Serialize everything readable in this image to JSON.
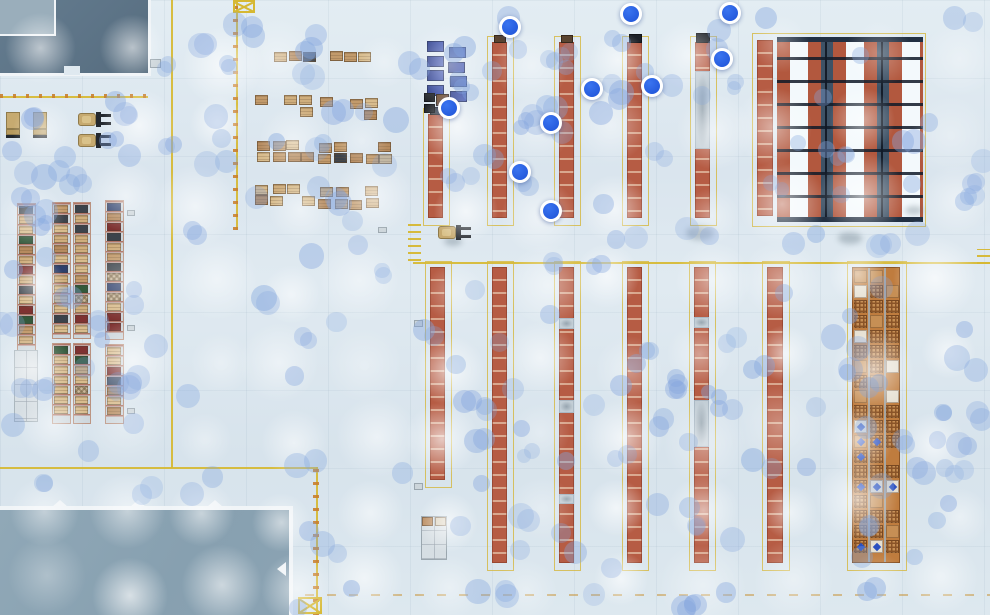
{
  "scene": {
    "label": "warehouse-floor-plan-top-view",
    "width": 990,
    "height": 615,
    "marker_count": 10
  },
  "palette": {
    "floor": "#dbe6ee",
    "zoneDark": "#5d7487",
    "zoneDarkPatch": "#9aaebb",
    "zoneDock": "#8ba3b3",
    "zoneBorder": "#f0f4f7",
    "yellow": "#d6b832",
    "orangeDash": "#c87f2e",
    "rackOrange": "#b65c44",
    "rackSep": "#d9a88f",
    "rackBorder": "rgba(135,58,38,0.6)",
    "rackGap": "#c3ced6",
    "capBrown": "#5a4430",
    "capDark": "#1d2127",
    "rbOrange": "#b2583e",
    "rbAisle": "#f3f9fc",
    "rbDark": "#3e5266",
    "rbBeam": "rgba(16,26,40,0.85)",
    "rbCap": "#223042",
    "denseBase": "#bf7c3e",
    "denseLattice": "#8a5428",
    "denseCell": "#c68f55",
    "denseWhite": "#e6e0d2",
    "denseBlue": "#2b50c0",
    "rowFrame": "#ccd5db",
    "rowBar": "rgba(168,84,62,0.75)",
    "tan1": "#cfae7d",
    "tan2": "#d8bc8d",
    "tan3": "#c29a6b",
    "tan4": "#b68b5f",
    "dark": "#3c434b",
    "green": "#33593b",
    "red": "#7e3231",
    "navy": "#2e3f6b",
    "checker": "#c9b79a",
    "bluePalletA": "#2c3d8c",
    "bluePalletB": "#4257b2",
    "vehicleBody": "#c6aa70",
    "vehicleTrim": "#8f7a4a",
    "vehicleDark": "#23282e",
    "dotRGB": "132,166,222",
    "marker": "#2257d8",
    "markerRing": "#ffffff",
    "smudge": "rgba(75,95,110,0.30)",
    "emptyRack": "#d6dee3",
    "emptyRackLine": "rgba(150,160,170,0.55)"
  },
  "markers": [
    [
      510,
      27
    ],
    [
      631,
      14
    ],
    [
      730,
      13
    ],
    [
      722,
      59
    ],
    [
      652,
      86
    ],
    [
      592,
      89
    ],
    [
      449,
      108
    ],
    [
      551,
      123
    ],
    [
      520,
      172
    ],
    [
      551,
      211
    ]
  ],
  "zones": {
    "building": {
      "rect": [
        0,
        0,
        148,
        73
      ],
      "patch": [
        0,
        0,
        54,
        34
      ],
      "notch": [
        64,
        66,
        16,
        9
      ]
    },
    "dock": {
      "rect": [
        0,
        506,
        289,
        109
      ],
      "teeth_x": [
        52,
        130,
        207
      ],
      "side_notch_y": 562
    }
  },
  "yellow_lines": {
    "solids": [
      [
        0,
        96,
        148,
        2
      ],
      [
        171,
        0,
        2,
        468
      ],
      [
        236,
        0,
        2,
        230
      ],
      [
        413,
        262,
        577,
        2
      ],
      [
        0,
        467,
        318,
        2
      ],
      [
        316,
        467,
        2,
        148
      ]
    ],
    "dash_overlays": [
      [
        0,
        94,
        148,
        4,
        "h"
      ],
      [
        233,
        0,
        5,
        230,
        "v"
      ],
      [
        313,
        467,
        6,
        148,
        "v"
      ]
    ],
    "dashed": [
      [
        305,
        594,
        685,
        2
      ]
    ],
    "xboxes": [
      [
        233,
        0,
        22,
        13
      ],
      [
        298,
        597,
        24,
        17
      ]
    ],
    "hatches": [
      [
        408,
        221,
        13,
        40
      ],
      [
        977,
        249,
        13,
        15
      ]
    ]
  },
  "racks": {
    "top": [
      {
        "r": [
          428,
          114,
          15,
          104
        ]
      },
      {
        "r": [
          492,
          42,
          15,
          176
        ]
      },
      {
        "r": [
          559,
          42,
          15,
          176
        ]
      },
      {
        "r": [
          627,
          42,
          15,
          176
        ]
      },
      {
        "r": [
          695,
          42,
          15,
          176
        ],
        "gaps": [
          [
            70,
            78
          ]
        ]
      }
    ],
    "bottom": [
      {
        "r": [
          430,
          267,
          15,
          213
        ]
      },
      {
        "r": [
          492,
          267,
          15,
          296
        ]
      },
      {
        "r": [
          559,
          267,
          15,
          296
        ],
        "gaps": [
          [
            317,
            11
          ],
          [
            399,
            13
          ],
          [
            493,
            10
          ]
        ]
      },
      {
        "r": [
          627,
          267,
          15,
          296
        ]
      },
      {
        "r": [
          694,
          267,
          15,
          296
        ],
        "gaps": [
          [
            316,
            11
          ],
          [
            399,
            47
          ]
        ]
      },
      {
        "r": [
          767,
          267,
          16,
          296
        ]
      }
    ],
    "caps": [
      [
        494,
        35,
        12,
        8,
        "capBrown"
      ],
      [
        561,
        35,
        12,
        8,
        "capBrown"
      ],
      [
        629,
        34,
        13,
        9,
        "capDark"
      ],
      [
        696,
        33,
        14,
        10,
        "capDark"
      ],
      [
        430,
        107,
        12,
        8,
        "dark"
      ]
    ]
  },
  "right_block": {
    "rect": [
      777,
      37,
      146,
      185
    ],
    "side_col": [
      757,
      40,
      16,
      176
    ],
    "outline": [
      752,
      33,
      172,
      192
    ],
    "beam_step": 23,
    "cap_h": 5
  },
  "dense_rack": {
    "rect": [
      852,
      267,
      48,
      296
    ],
    "cols": [
      1,
      17,
      33
    ],
    "cell_w": 13,
    "row_step": 15,
    "cell_h": 13
  },
  "left_rows": {
    "segments": [
      [
        17,
        203,
        19,
        148
      ],
      [
        52,
        202,
        19,
        137
      ],
      [
        52,
        343,
        19,
        81
      ],
      [
        73,
        202,
        18,
        137
      ],
      [
        73,
        343,
        18,
        81
      ],
      [
        105,
        200,
        19,
        140
      ],
      [
        105,
        344,
        19,
        80
      ]
    ],
    "empty_rack": [
      14,
      350,
      24,
      72
    ]
  },
  "pallet_clusters": [
    [
      257,
      51,
      62,
      22
    ],
    [
      328,
      51,
      46,
      21
    ],
    [
      253,
      94,
      64,
      24
    ],
    [
      318,
      97,
      74,
      24
    ],
    [
      255,
      139,
      64,
      24
    ],
    [
      318,
      141,
      76,
      25
    ],
    [
      255,
      183,
      70,
      26
    ],
    [
      318,
      186,
      74,
      26
    ]
  ],
  "blue_pallets": {
    "cols": [
      426,
      448
    ],
    "row_y": [
      41,
      47
    ],
    "step": 14.5,
    "rows": 4,
    "w": 17,
    "h": 11
  },
  "crates": [
    [
      424,
      93,
      11,
      9,
      "#23262b"
    ],
    [
      424,
      104,
      11,
      9,
      "#23262b"
    ],
    [
      436,
      94,
      13,
      12,
      "#6e4c30"
    ]
  ],
  "vehicles": {
    "trucks_down": [
      [
        6,
        112
      ],
      [
        33,
        112
      ]
    ],
    "forklifts_right": [
      [
        78,
        111
      ],
      [
        78,
        132
      ],
      [
        438,
        224
      ]
    ]
  },
  "shelves": {
    "bottom_shelf": [
      421,
      516,
      26,
      44
    ],
    "shelf_pallets": [
      [
        422,
        517,
        11,
        9,
        "#b98a5c"
      ],
      [
        435,
        517,
        11,
        9,
        "#d8cdb6"
      ]
    ]
  },
  "small_items": [
    [
      150,
      59,
      11,
      9
    ],
    [
      378,
      227,
      9,
      6
    ],
    [
      127,
      210,
      8,
      6
    ],
    [
      127,
      325,
      8,
      6
    ],
    [
      127,
      408,
      8,
      6
    ],
    [
      414,
      320,
      9,
      7
    ],
    [
      414,
      483,
      9,
      7
    ]
  ],
  "smudges": [
    [
      686,
      226,
      28,
      14
    ],
    [
      838,
      232,
      24,
      12
    ],
    [
      444,
      236,
      18,
      10
    ],
    [
      905,
      206,
      18,
      9
    ]
  ],
  "ambient": {
    "seed": 42,
    "dot_count": 225,
    "dot_r_min": 8,
    "dot_r_max": 13,
    "glow_grid": {
      "x0": 45,
      "y0": 55,
      "dx": 82,
      "dy": 76,
      "cols": 12,
      "rows": 8
    }
  }
}
